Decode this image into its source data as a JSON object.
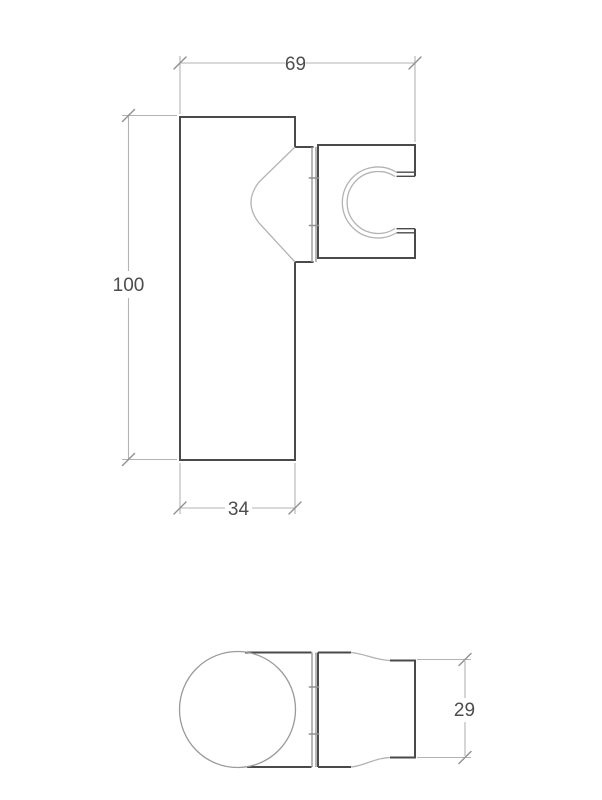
{
  "colors": {
    "background": "#ffffff",
    "outline": "#4a4a4a",
    "thin_line": "#b3b3b3",
    "medium_line": "#9a9a9a",
    "tick": "#8f8f8f",
    "text": "#4d4d4d"
  },
  "front_view": {
    "width_label": "69",
    "height_label": "100",
    "plate_width_label": "34"
  },
  "plan_view": {
    "depth_label": "29"
  }
}
